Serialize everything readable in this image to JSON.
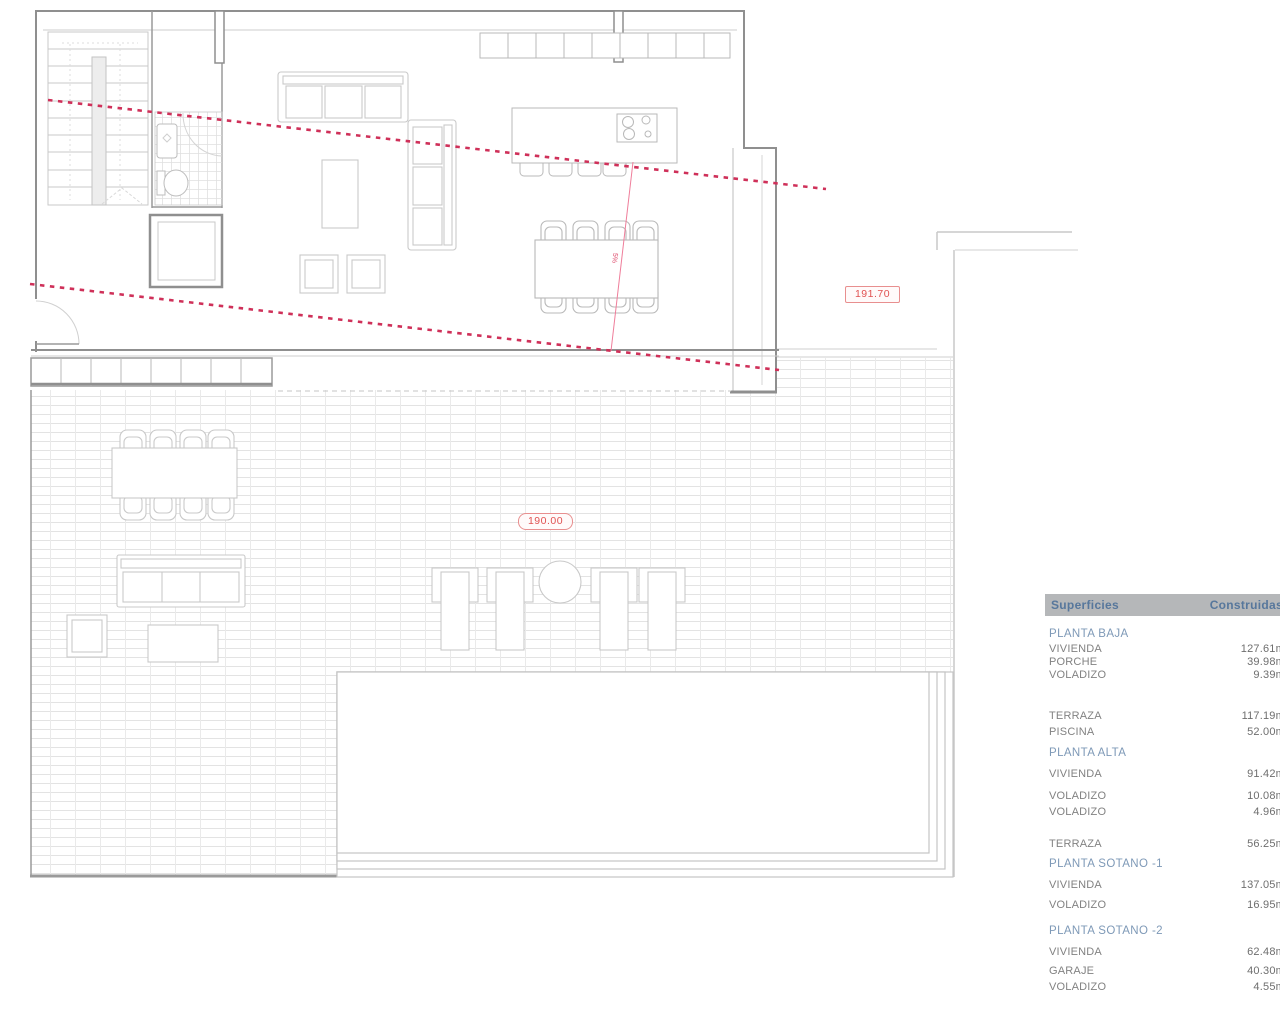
{
  "plan": {
    "labels": {
      "upper_level": "191.70",
      "terrace_level": "190.00",
      "slope_note": "5%"
    }
  },
  "table": {
    "header": {
      "col1": "Superficies",
      "col2": "Construidas"
    },
    "rows": [
      {
        "type": "section",
        "label": "PLANTA BAJA",
        "value": ""
      },
      {
        "type": "item",
        "label": "VIVIENDA",
        "value": "127.61m"
      },
      {
        "type": "item",
        "label": "PORCHE",
        "value": "39.98m"
      },
      {
        "type": "item",
        "label": "VOLADIZO",
        "value": "9.39m"
      },
      {
        "type": "item",
        "label": "TERRAZA",
        "value": "117.19m"
      },
      {
        "type": "item",
        "label": "PISCINA",
        "value": "52.00m"
      },
      {
        "type": "section",
        "label": "PLANTA ALTA",
        "value": ""
      },
      {
        "type": "item",
        "label": "VIVIENDA",
        "value": "91.42m"
      },
      {
        "type": "item",
        "label": "VOLADIZO",
        "value": "10.08m"
      },
      {
        "type": "item",
        "label": "VOLADIZO",
        "value": "4.96m"
      },
      {
        "type": "item",
        "label": "TERRAZA",
        "value": "56.25m"
      },
      {
        "type": "section",
        "label": "PLANTA SOTANO -1",
        "value": ""
      },
      {
        "type": "item",
        "label": "VIVIENDA",
        "value": "137.05m"
      },
      {
        "type": "item",
        "label": "VOLADIZO",
        "value": "16.95m"
      },
      {
        "type": "section",
        "label": "PLANTA SOTANO -2",
        "value": ""
      },
      {
        "type": "item",
        "label": "VIVIENDA",
        "value": "62.48m"
      },
      {
        "type": "item",
        "label": "GARAJE",
        "value": "40.30m"
      },
      {
        "type": "item",
        "label": "VOLADIZO",
        "value": "4.55m"
      }
    ]
  }
}
